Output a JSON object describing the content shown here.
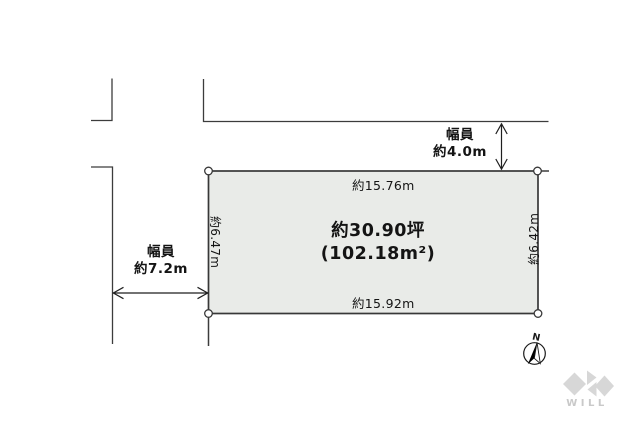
{
  "diagram_title": "land-plot-layout",
  "parcel": {
    "tsubo_label": "約30.90坪",
    "area_label": "(102.18m²)",
    "top_dimension": "約15.76m",
    "bottom_dimension": "約15.92m",
    "left_dimension": "約6.47m",
    "right_dimension": "約6.42m"
  },
  "roads": {
    "top": {
      "label_line1": "幅員",
      "label_line2": "約4.0m"
    },
    "left": {
      "label_line1": "幅員",
      "label_line2": "約7.2m"
    }
  },
  "compass": {
    "north_label": "N"
  },
  "logo": {
    "text": "WILL"
  },
  "colors": {
    "parcel_fill": "#e9ebe8",
    "line": "#3c3c3c",
    "text": "#141414",
    "logo_gray": "#d7d7d7",
    "logo_text_gray": "#c9c9c9"
  }
}
